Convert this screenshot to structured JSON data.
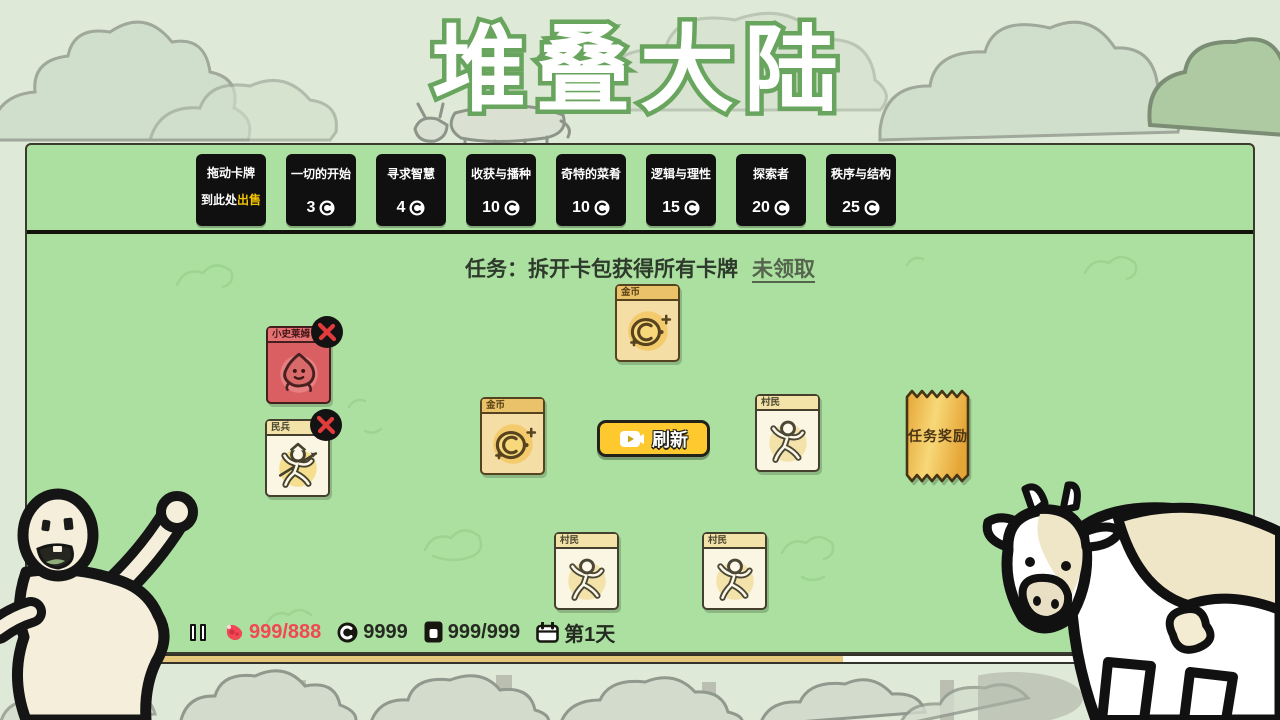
{
  "title": "堆叠大陆",
  "shop": {
    "sell_slot": {
      "line1": "拖动卡牌",
      "line2_prefix": "到此处",
      "line2_highlight": "出售"
    },
    "packs": [
      {
        "name": "一切的开始",
        "price": "3"
      },
      {
        "name": "寻求智慧",
        "price": "4"
      },
      {
        "name": "收获与播种",
        "price": "10"
      },
      {
        "name": "奇特的菜肴",
        "price": "10"
      },
      {
        "name": "逻辑与理性",
        "price": "15"
      },
      {
        "name": "探索者",
        "price": "20"
      },
      {
        "name": "秩序与结构",
        "price": "25"
      }
    ]
  },
  "quest": {
    "label": "任务：拆开卡包获得所有卡牌",
    "claim": "未领取"
  },
  "cards": [
    {
      "title": "金币",
      "type": "coin"
    },
    {
      "title": "金币",
      "type": "coin"
    },
    {
      "title": "小史莱姆",
      "type": "enemy"
    },
    {
      "title": "民兵",
      "type": "militia"
    },
    {
      "title": "村民",
      "type": "villager"
    },
    {
      "title": "村民",
      "type": "villager"
    },
    {
      "title": "村民",
      "type": "villager"
    }
  ],
  "refresh_button": {
    "label": "刷新"
  },
  "reward_ticket": {
    "label": "任务奖励"
  },
  "status_bar": {
    "food": "999/888",
    "coins": "9999",
    "cards": "999/999",
    "day": "第1天"
  },
  "icons": {
    "pause": "pause-icon",
    "food": "meat-icon",
    "coin": "coin-icon",
    "cards": "card-stack-icon",
    "day": "calendar-icon",
    "refresh": "video-play-icon",
    "attack": "red-x-badge"
  },
  "colors": {
    "board_green": "#abe0a0",
    "background": "#dfe9d7",
    "pack_black": "#101010",
    "accent_yellow": "#fdc92f",
    "highlight_yellow": "#f2c200",
    "alert_red": "#f24755",
    "gold_bar": "#e6c87d",
    "title_outline_green": "#69a55e",
    "enemy_red": "#d95f63"
  }
}
